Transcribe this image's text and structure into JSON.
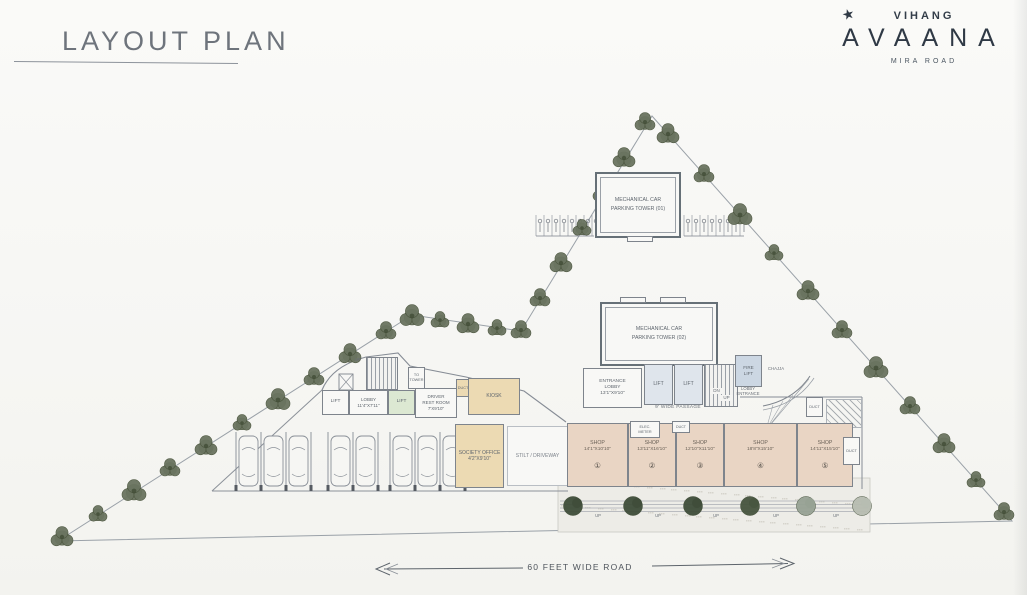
{
  "header": {
    "title": "LAYOUT PLAN"
  },
  "logo": {
    "star_icon": "★",
    "brand": "VIHANG",
    "name": "AVAANA",
    "location": "MIRA ROAD"
  },
  "plan": {
    "tower1_label": "MECHANICAL CAR\nPARKING TOWER (01)",
    "tower2_label": "MECHANICAL CAR\nPARKING TOWER (02)",
    "passage_label": "9' WIDE PASSAGE",
    "left_wing": {
      "up": "UP",
      "lift": "LIFT",
      "lobby": "LOBBY\n11'4\"X7'11\"",
      "to_tower": "TO\nTOWER",
      "driver_rest_room": "DRIVER\nREST ROOM\n7'X9'10\"",
      "kiosk": "KIOSK",
      "society_office": "SOCIETY OFFICE\n4'2\"X9'10\"",
      "stilt_driveway": "STILT / DRIVEWAY"
    },
    "core": {
      "entrance_lobby": "ENTRANCE\nLOBBY\n13'1\"X9'10\"",
      "lift": "LIFT",
      "dn": "DN",
      "up": "UP",
      "fire_lift": "FIRE\nLIFT",
      "lobby_entrance": "LOBBY\nENTRANCE",
      "chajja": "CHAJJA"
    },
    "service": {
      "duct": "DUCT",
      "elec_meter": "ELEC.\nMETER"
    },
    "shops": [
      {
        "name": "SHOP",
        "dim": "14'1\"X10'10\"",
        "num": "①"
      },
      {
        "name": "SHOP",
        "dim": "13'11\"X16'10\"",
        "num": "②"
      },
      {
        "name": "SHOP",
        "dim": "12'10\"X11'10\"",
        "num": "③"
      },
      {
        "name": "SHOP",
        "dim": "18'8\"X15'10\"",
        "num": "④"
      },
      {
        "name": "SHOP",
        "dim": "14'11\"X15'10\"",
        "num": "⑤"
      }
    ],
    "steps_up": "UP"
  },
  "road": {
    "label": "60 FEET WIDE ROAD"
  }
}
